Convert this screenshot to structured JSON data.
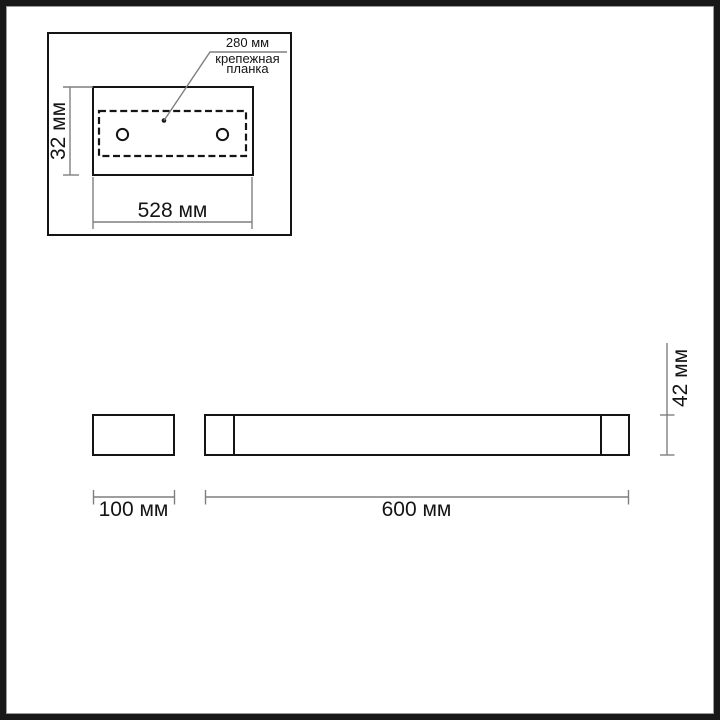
{
  "colors": {
    "ink": "#141414",
    "dim": "#7f7f7f",
    "bg": "#ffffff",
    "frame": "#181818"
  },
  "inset": {
    "callout_dimension": "280 мм",
    "callout_label": "крепежная планка",
    "height_dimension": "32 мм",
    "width_dimension": "528 мм"
  },
  "side_view": {
    "width_dimension": "100 мм"
  },
  "front_view": {
    "width_dimension": "600 мм",
    "height_dimension": "42 мм"
  }
}
